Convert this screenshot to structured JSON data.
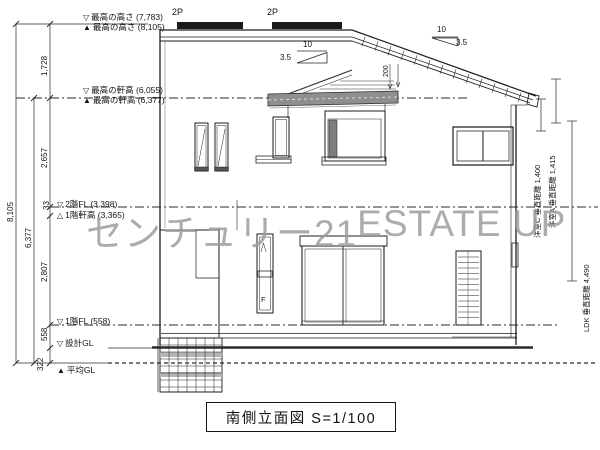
{
  "title_block": {
    "text": "南側立面図 S=1/100"
  },
  "watermark": {
    "left": "センチュリー21",
    "right": "ESTATE UP"
  },
  "levels": [
    {
      "marker": "▽",
      "label": "最高の高さ (7,783)"
    },
    {
      "marker": "▲",
      "label": "最高の高さ (8,105)"
    },
    {
      "marker": "▽",
      "label": "最高の軒高 (6,055)"
    },
    {
      "marker": "▲",
      "label": "最高の軒高 (6,377)"
    },
    {
      "marker": "▽",
      "label": "2階FL (3,398)"
    },
    {
      "marker": "△",
      "label": "1階軒高 (3,365)"
    },
    {
      "marker": "▽",
      "label": "1階FL (558)"
    },
    {
      "marker": "▽",
      "label": "設計GL"
    },
    {
      "marker": "▲",
      "label": "平均GL"
    }
  ],
  "dims": {
    "overall": "8,105",
    "eave_total": "6,377",
    "upper": "1,728",
    "second": "2,657",
    "gap": "33",
    "first": "2,807",
    "fl1": "558",
    "gl": "322",
    "roof_drop": "200"
  },
  "roof": {
    "panel1": "2P",
    "panel2": "2P",
    "slope": {
      "run": "10",
      "rise": "3.5"
    }
  },
  "daylight": [
    {
      "label": "洋室C 垂直距離 1,400"
    },
    {
      "label": "洋室A 垂直距離 1,415"
    },
    {
      "label": "LDK 垂直距離 4,490"
    }
  ],
  "marks": {
    "fix": "F"
  }
}
